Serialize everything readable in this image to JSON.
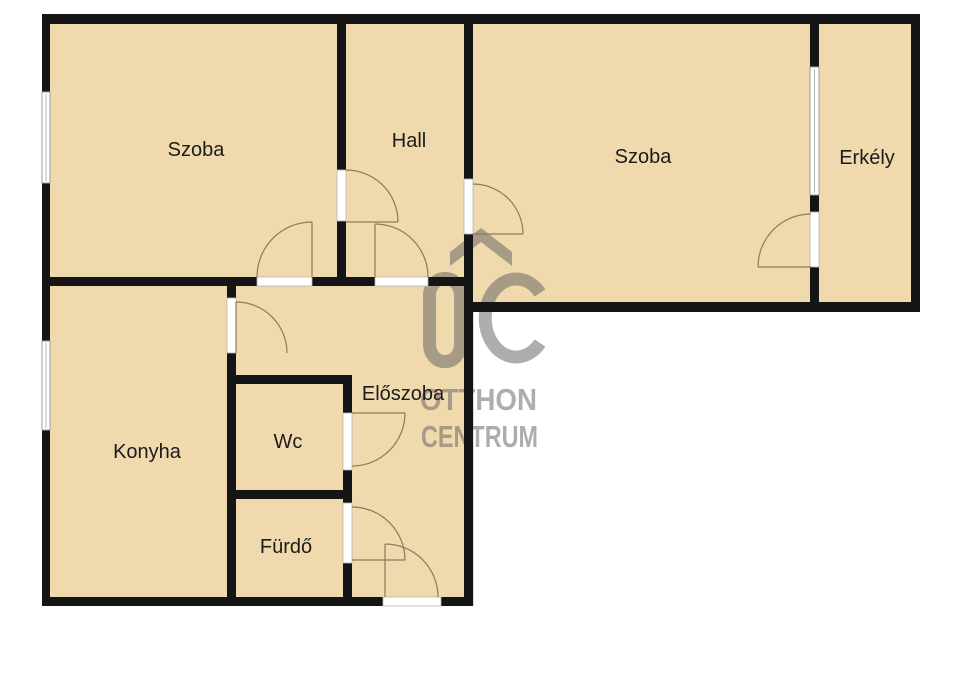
{
  "image": {
    "type": "floor-plan",
    "width": 960,
    "height": 679
  },
  "rooms": [
    {
      "id": "szoba-left",
      "label": "Szoba"
    },
    {
      "id": "hall",
      "label": "Hall"
    },
    {
      "id": "szoba-right",
      "label": "Szoba"
    },
    {
      "id": "erkely",
      "label": "Erkély"
    },
    {
      "id": "konyha",
      "label": "Konyha"
    },
    {
      "id": "wc",
      "label": "Wc"
    },
    {
      "id": "furdo",
      "label": "Fürdő"
    },
    {
      "id": "eloszoba",
      "label": "Előszoba"
    }
  ],
  "watermark": {
    "logo": "otthon-centrum-house-logo",
    "line1": "OTTHON",
    "line2": "CENTRUM"
  },
  "colors": {
    "floor": "#f0daad",
    "wall": "#151515",
    "door_arc": "#8c7a5c",
    "window_frame": "#9e9e9e",
    "watermark_gray": "#5e5e5e",
    "label_text": "#1b1b1b",
    "background": "#ffffff"
  }
}
